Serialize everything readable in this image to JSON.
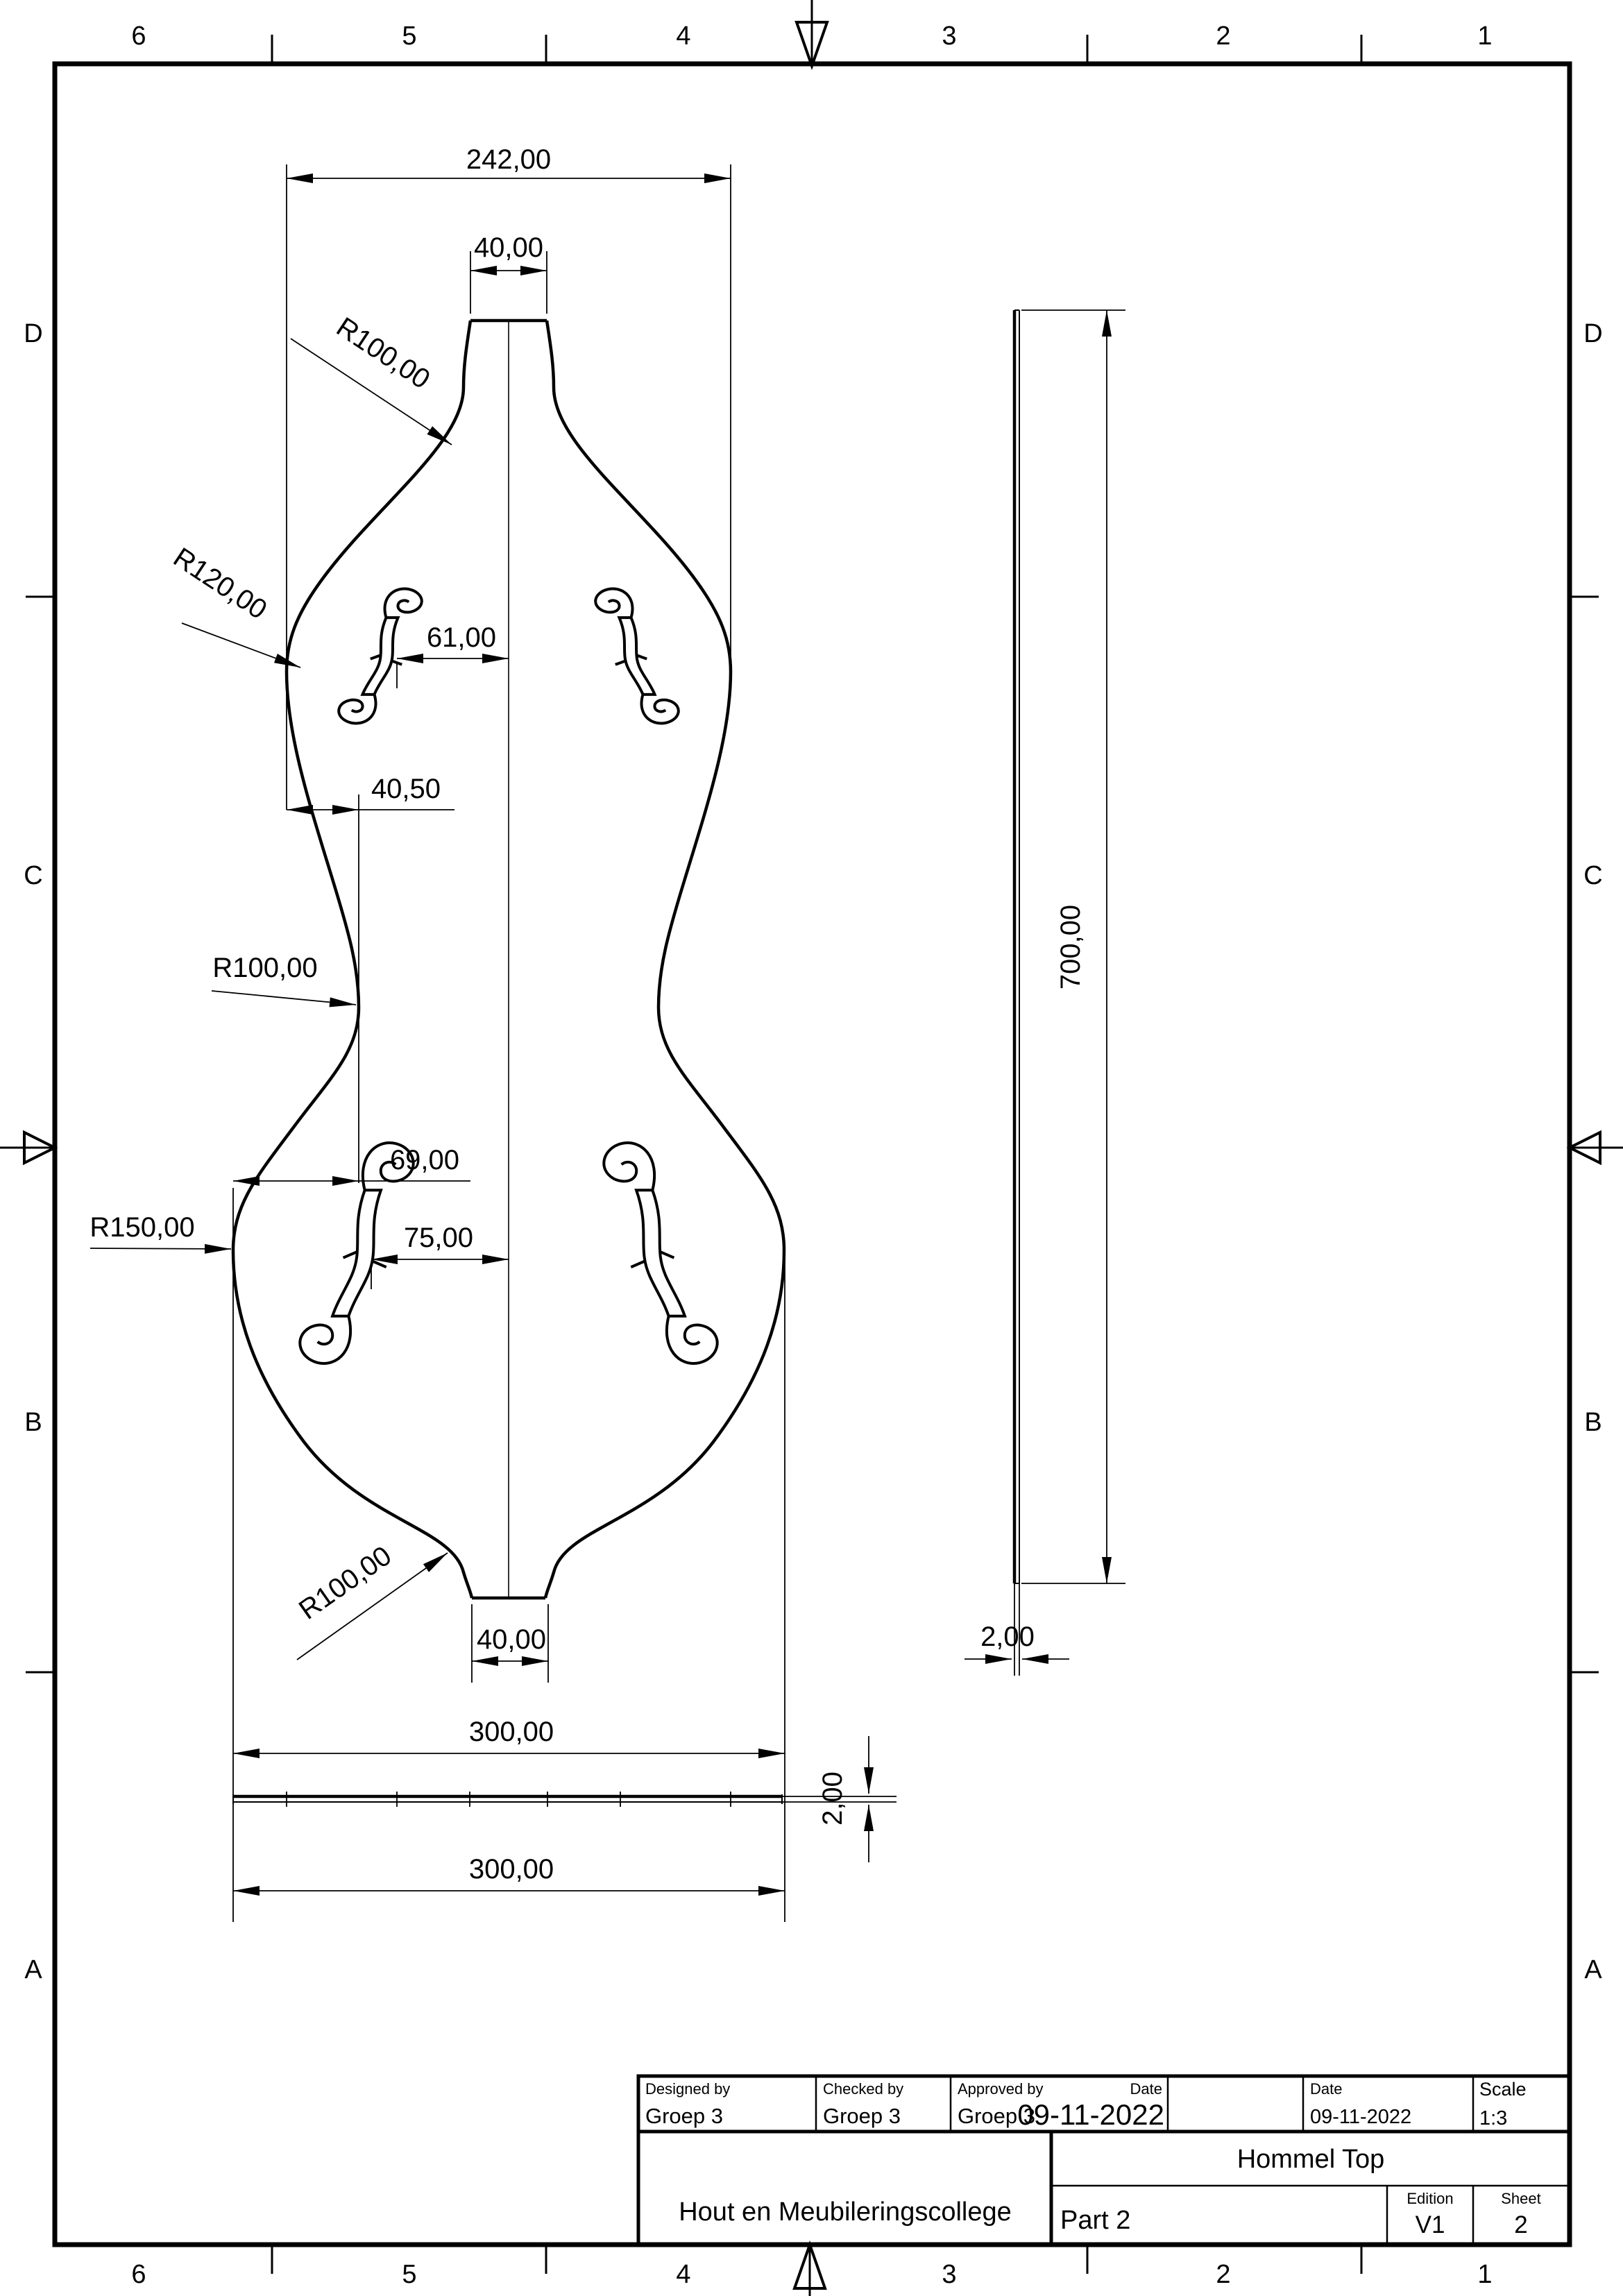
{
  "border": {
    "columns": [
      "6",
      "5",
      "4",
      "3",
      "2",
      "1"
    ],
    "rows": [
      "D",
      "C",
      "B",
      "A"
    ]
  },
  "front_view": {
    "top_width": "242,00",
    "neck_width": "40,00",
    "neck_radius": "R100,00",
    "upper_bout_radius": "R120,00",
    "fhole_upper_offset": "61,00",
    "waist_offset": "40,50",
    "waist_radius": "R100,00",
    "bout_offset": "69,00",
    "lower_bout_radius": "R150,00",
    "fhole_lower_offset": "75,00",
    "tail_radius": "R100,00",
    "tail_width": "40,00",
    "bottom_width": "300,00"
  },
  "side_view": {
    "length": "700,00",
    "thickness": "2,00"
  },
  "bottom_view": {
    "width": "300,00",
    "thickness": "2,00"
  },
  "title_block": {
    "designed_by_label": "Designed by",
    "designed_by": "Groep 3",
    "checked_by_label": "Checked by",
    "checked_by": "Groep 3",
    "approved_by_label": "Approved by",
    "approved_by": "Groep 3",
    "approved_date_label": "Date",
    "approved_date": "09-11-2022",
    "date_label": "Date",
    "date": "09-11-2022",
    "scale_label": "Scale",
    "scale": "1:3",
    "company": "Hout en Meubileringscollege",
    "drawing_title": "Hommel Top",
    "part": "Part 2",
    "edition_label": "Edition",
    "edition": "V1",
    "sheet_label": "Sheet",
    "sheet_number": "2"
  }
}
